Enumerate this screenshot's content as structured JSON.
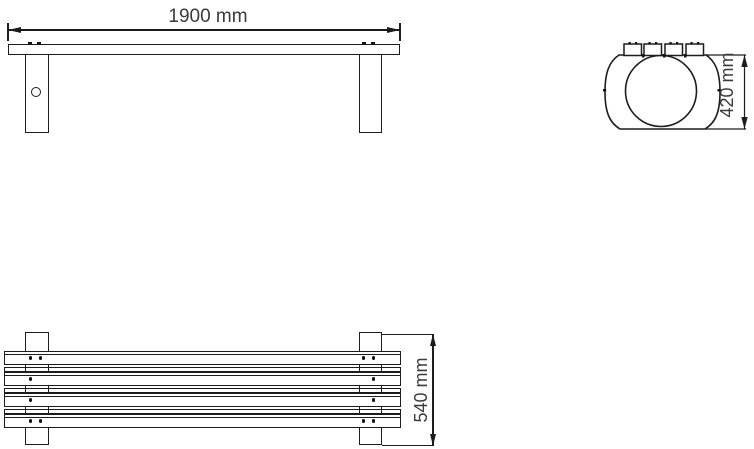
{
  "views": {
    "front": {
      "dim_label": "1900 mm"
    },
    "side": {
      "dim_label": "420 mm"
    },
    "plan": {
      "dim_label": "540 mm"
    }
  },
  "colors": {
    "line": "#1c1c1c",
    "text": "#3a3a3a",
    "background": "#ffffff"
  }
}
